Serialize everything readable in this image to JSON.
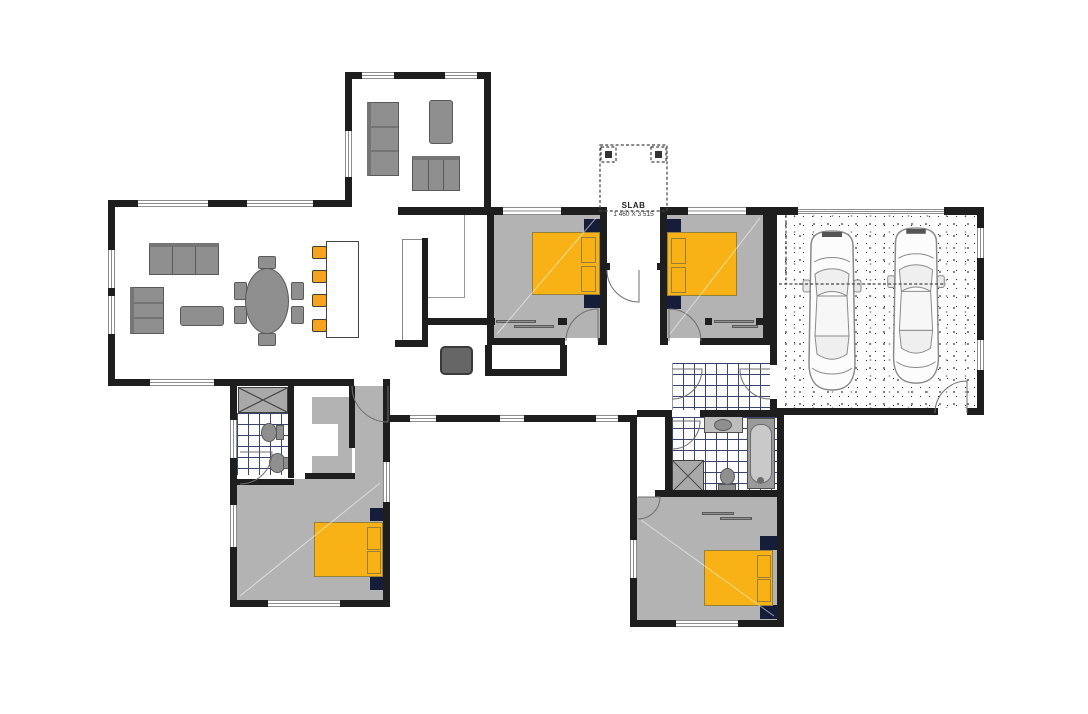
{
  "labels": {
    "slab_title": "SLAB",
    "slab_dimensions": "1 460 X 3 515"
  },
  "colors": {
    "wall": "#1e1e1e",
    "room_grey": "#b3b3b3",
    "furniture_grey": "#8f8f8f",
    "furniture_edge": "#5a5a5a",
    "bed_yellow": "#f9b215",
    "bed_edge": "#97803a",
    "stool_orange": "#f6a41c",
    "navy": "#161d3a",
    "tile_grid": "#39456b",
    "window_line": "#8d8d8d",
    "door_arc": "#6f6f6f",
    "dash_line": "#444444"
  },
  "icons": {
    "double-bed-icon": 4,
    "car-icon": 2,
    "bar-stool-icon": 4,
    "sofa-icon": 3,
    "armchair-icon": 2,
    "dining-table-icon": 1,
    "dining-chair-icon": 6,
    "kitchen-island-icon": 1,
    "coffee-table-icon": 1,
    "desk-chair-icon": 1,
    "toilet-icon": 2,
    "basin-icon": 2,
    "shower-icon": 2,
    "bathtub-icon": 1,
    "door-swing-icon": 10,
    "window-icon": 21,
    "porch-column-icon": 2
  }
}
